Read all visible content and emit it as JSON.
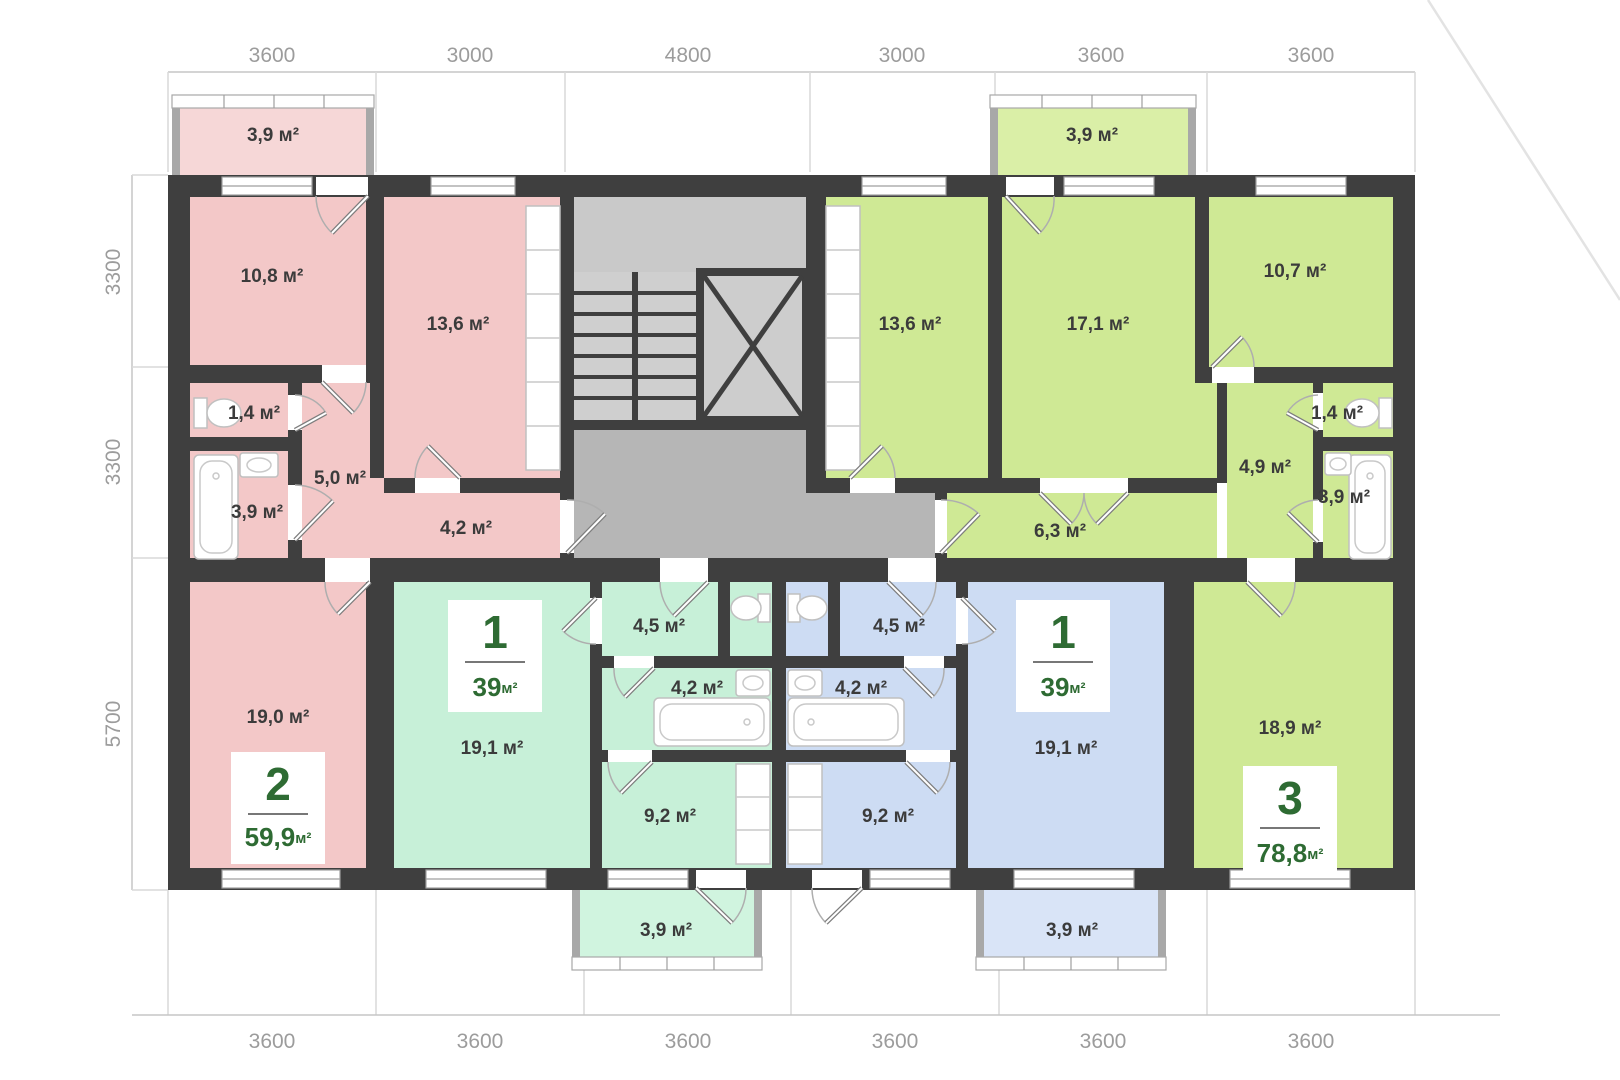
{
  "colors": {
    "wall": "#3f3f3f",
    "pink": "#f3c8c8",
    "pink_light": "#f6d7d7",
    "mint": "#c7f0d8",
    "mint_light": "#d0f4df",
    "blue": "#cddcf3",
    "blue_light": "#d9e4f7",
    "lime": "#cfe995",
    "lime_light": "#daefa7",
    "hall_gray": "#b6b6b6",
    "stair_gray": "#cfcfcf",
    "landing_gray": "#c9c9c9",
    "elevator_gray": "#cdcdcd",
    "badge_text": "#2e6b33"
  },
  "dims": {
    "top": [
      "3600",
      "3000",
      "4800",
      "3000",
      "3600",
      "3600"
    ],
    "left": [
      "3300",
      "3300",
      "5700"
    ],
    "bottom": [
      "3600",
      "3600",
      "3600",
      "3600",
      "3600",
      "3600"
    ]
  },
  "rooms": {
    "pink_balcony": "3,9 м²",
    "pink_bedroom": "10,8 м²",
    "pink_kitchen": "13,6 м²",
    "pink_wc": "1,4 м²",
    "pink_bath": "3,9 м²",
    "pink_hall": "5,0 м²",
    "pink_corridor": "4,2 м²",
    "pink_living": "19,0 м²",
    "mint_living": "19,1 м²",
    "mint_hall": "4,5 м²",
    "mint_bath": "4,2 м²",
    "mint_kitchen": "9,2 м²",
    "mint_balcony": "3,9 м²",
    "blue_living": "19,1 м²",
    "blue_hall": "4,5 м²",
    "blue_bath": "4,2 м²",
    "blue_kitchen": "9,2 м²",
    "blue_balcony": "3,9 м²",
    "green_kitchen": "13,6 м²",
    "green_room_17": "17,1 м²",
    "green_room_10": "10,7 м²",
    "green_wc": "1,4 м²",
    "green_bath": "3,9 м²",
    "green_hall": "4,9 м²",
    "green_corridor": "6,3 м²",
    "green_living": "18,9 м²",
    "green_balcony": "3,9 м²"
  },
  "badges": {
    "pink": {
      "rooms": "2",
      "area": "59,9",
      "unit": "м²"
    },
    "mint": {
      "rooms": "1",
      "area": "39",
      "unit": "м²"
    },
    "blue": {
      "rooms": "1",
      "area": "39",
      "unit": "м²"
    },
    "green": {
      "rooms": "3",
      "area": "78,8",
      "unit": "м²"
    }
  }
}
